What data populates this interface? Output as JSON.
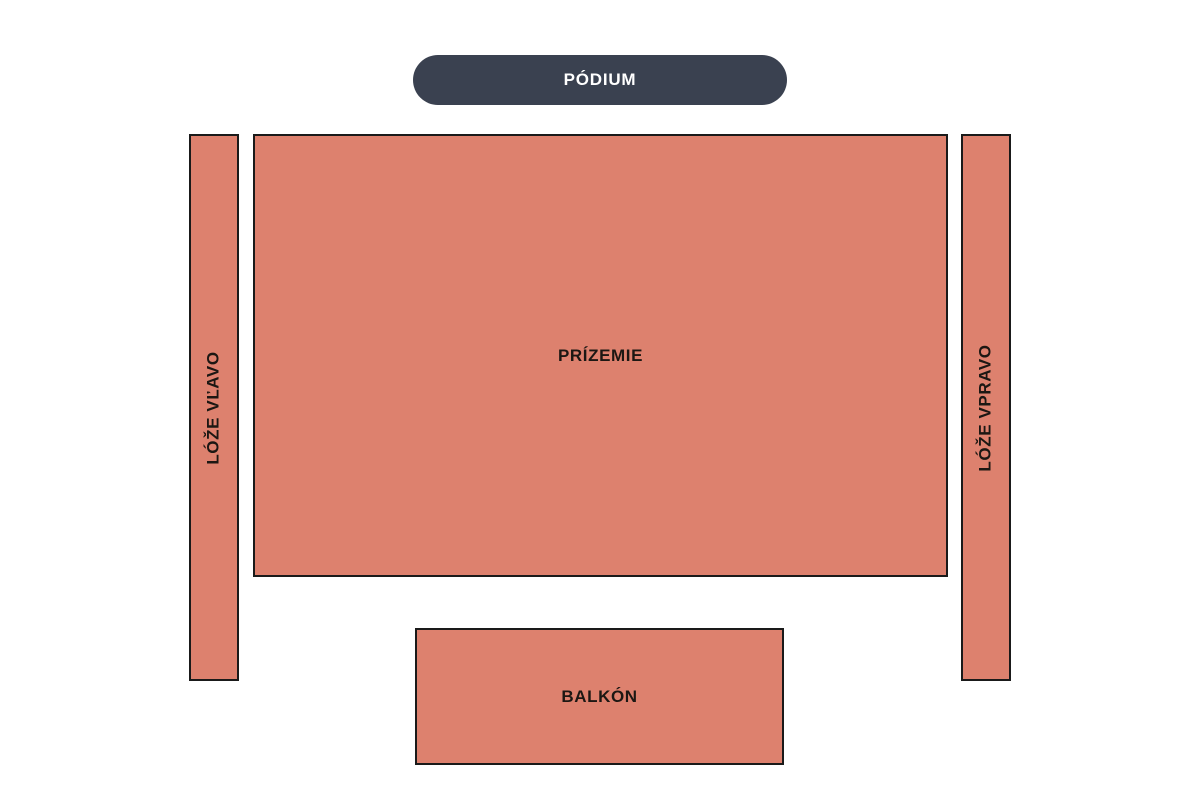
{
  "colors": {
    "section_fill": "#dd816e",
    "section_border": "#1a1a1a",
    "stage_fill": "#3a4150",
    "stage_text": "#ffffff",
    "label_text": "#1c1713",
    "page_bg": "#ffffff"
  },
  "stage": {
    "label": "PÓDIUM"
  },
  "sections": {
    "left_box": {
      "label": "LÓŽE VĽAVO"
    },
    "main_floor": {
      "label": "PRÍZEMIE"
    },
    "right_box": {
      "label": "LÓŽE VPRAVO"
    },
    "balcony": {
      "label": "BALKÓN"
    }
  }
}
